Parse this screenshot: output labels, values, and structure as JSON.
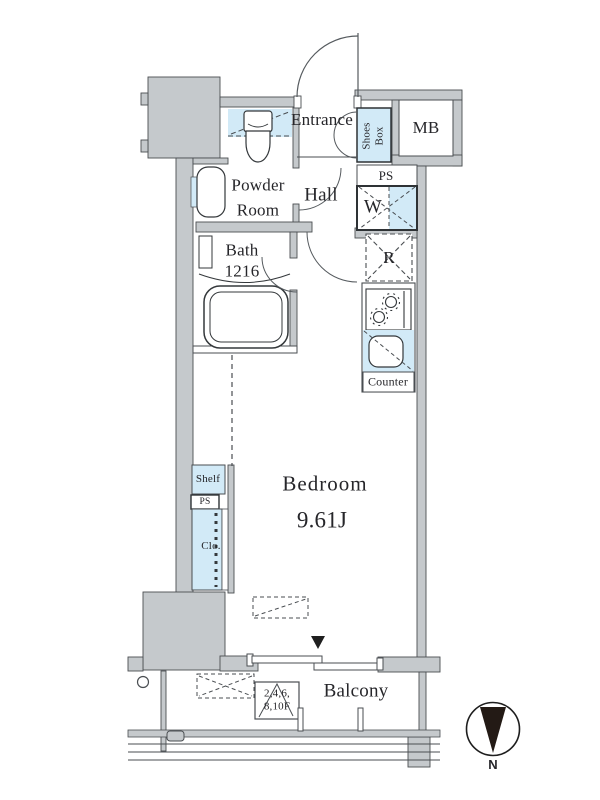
{
  "colors": {
    "wall": "#c5c9cc",
    "blue": "#d2eaf7",
    "line": "#4a4e52",
    "ink": "#26262a"
  },
  "rooms": {
    "entrance": "Entrance",
    "hall": "Hall",
    "powder_room": {
      "line1": "Powder",
      "line2": "Room"
    },
    "bath": {
      "line1": "Bath",
      "line2": "1216"
    },
    "bedroom": {
      "name": "Bedroom",
      "size": "9.61J"
    },
    "balcony": "Balcony"
  },
  "fixtures": {
    "shoes_box": {
      "line1": "Shoes",
      "line2": "Box"
    },
    "mb": "MB",
    "ps_upper": "PS",
    "washer": "W",
    "refrigerator": "R",
    "counter": "Counter",
    "shelf": "Shelf",
    "ps_lower": "PS",
    "closet": "Clo."
  },
  "annotations": {
    "floors": {
      "line1": "2,4,6,",
      "line2": "8,10F"
    },
    "compass_north": "N"
  }
}
